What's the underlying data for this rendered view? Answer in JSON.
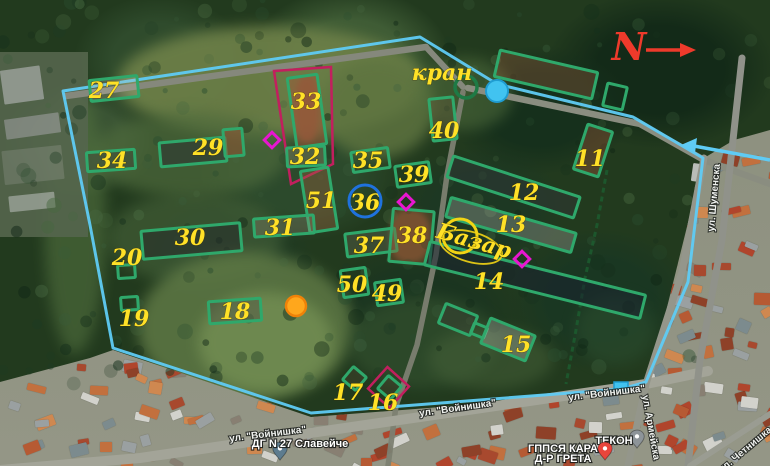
{
  "map_data": {
    "compass_label": "N",
    "annotations": {
      "crane": {
        "text": "кран",
        "x": 442,
        "y": 80,
        "rot": 0
      },
      "bazaar": {
        "text": "Базар",
        "x": 472,
        "y": 248,
        "rot": 16
      }
    },
    "style": {
      "boundary_cyan": "#5fcbf4",
      "building_green": "#2fa86b",
      "number_yellow": "#ffe127",
      "magenta": "#e816d0",
      "crimson": "#c21f5e",
      "blue_circle": "#1f72dd",
      "yellow_circle": "#f2d414",
      "orange_fill": "#ffa71c",
      "orange_stroke": "#ef8208",
      "cyan_fill": "#41c3f0",
      "cyan_stroke": "#1f9cd1",
      "crane_green": "#1e7a45",
      "north_red": "#ee3a2b",
      "dark_green_dash": "#1c5c2f"
    },
    "buildings": [
      {
        "id": "27",
        "label": "27",
        "x": 90,
        "y": 78,
        "w": 48,
        "h": 21,
        "rot": -6,
        "lx": 104,
        "ly": 90,
        "fill": "rgba(205,195,175,0.25)"
      },
      {
        "id": "34",
        "label": "34",
        "x": 87,
        "y": 151,
        "w": 48,
        "h": 19,
        "rot": -4,
        "lx": 112,
        "ly": 160,
        "fill": "rgba(60,65,60,0.35)"
      },
      {
        "id": "29",
        "label": "29",
        "x": 160,
        "y": 140,
        "w": 66,
        "h": 24,
        "rot": -5,
        "lx": 208,
        "ly": 147,
        "fill": "rgba(40,45,50,0.45)"
      },
      {
        "id": "29a",
        "label": "",
        "x": 224,
        "y": 129,
        "w": 19,
        "h": 27,
        "rot": -5,
        "lx": 0,
        "ly": 0,
        "fill": "rgba(160,80,50,0.45)"
      },
      {
        "id": "33",
        "label": "33",
        "x": 292,
        "y": 76,
        "w": 30,
        "h": 70,
        "rot": -8,
        "lx": 306,
        "ly": 101,
        "fill": "rgba(160,85,55,0.5)"
      },
      {
        "id": "32",
        "label": "32",
        "x": 287,
        "y": 147,
        "w": 38,
        "h": 19,
        "rot": -3,
        "lx": 305,
        "ly": 156,
        "fill": "rgba(170,150,120,0.3)"
      },
      {
        "id": "51",
        "label": "51",
        "x": 305,
        "y": 169,
        "w": 28,
        "h": 62,
        "rot": -9,
        "lx": 321,
        "ly": 200,
        "fill": "rgba(150,95,60,0.4)"
      },
      {
        "id": "31",
        "label": "31",
        "x": 254,
        "y": 217,
        "w": 60,
        "h": 18,
        "rot": -4,
        "lx": 280,
        "ly": 227,
        "fill": "rgba(150,140,120,0.3)"
      },
      {
        "id": "30",
        "label": "30",
        "x": 142,
        "y": 227,
        "w": 99,
        "h": 28,
        "rot": -5,
        "lx": 190,
        "ly": 237,
        "fill": "rgba(35,40,42,0.5)"
      },
      {
        "id": "20",
        "label": "20",
        "x": 118,
        "y": 265,
        "w": 17,
        "h": 13,
        "rot": -4,
        "lx": 127,
        "ly": 257,
        "fill": "none"
      },
      {
        "id": "19",
        "label": "19",
        "x": 121,
        "y": 297,
        "w": 17,
        "h": 13,
        "rot": -4,
        "lx": 134,
        "ly": 318,
        "fill": "none"
      },
      {
        "id": "18",
        "label": "18",
        "x": 209,
        "y": 300,
        "w": 52,
        "h": 22,
        "rot": -4,
        "lx": 235,
        "ly": 311,
        "fill": "rgba(75,75,68,0.4)"
      },
      {
        "id": "35",
        "label": "35",
        "x": 352,
        "y": 150,
        "w": 37,
        "h": 20,
        "rot": -8,
        "lx": 368,
        "ly": 160,
        "fill": "none"
      },
      {
        "id": "39",
        "label": "39",
        "x": 396,
        "y": 164,
        "w": 34,
        "h": 21,
        "rot": -8,
        "lx": 414,
        "ly": 174,
        "fill": "none"
      },
      {
        "id": "36",
        "label": "36",
        "x": 365,
        "y": 202,
        "w": 0,
        "h": 0,
        "rot": 0,
        "lx": 365,
        "ly": 202,
        "fill": "none"
      },
      {
        "id": "37",
        "label": "37",
        "x": 346,
        "y": 231,
        "w": 50,
        "h": 23,
        "rot": -7,
        "lx": 369,
        "ly": 245,
        "fill": "rgba(120,115,100,0.3)"
      },
      {
        "id": "38",
        "label": "38",
        "x": 391,
        "y": 210,
        "w": 41,
        "h": 53,
        "rot": 5,
        "lx": 412,
        "ly": 235,
        "fill": "rgba(145,85,50,0.35)"
      },
      {
        "id": "50",
        "label": "50",
        "x": 342,
        "y": 269,
        "w": 25,
        "h": 27,
        "rot": -8,
        "lx": 352,
        "ly": 284,
        "fill": "none"
      },
      {
        "id": "49",
        "label": "49",
        "x": 376,
        "y": 281,
        "w": 26,
        "h": 23,
        "rot": -8,
        "lx": 387,
        "ly": 293,
        "fill": "none"
      },
      {
        "id": "40",
        "label": "40",
        "x": 431,
        "y": 98,
        "w": 24,
        "h": 42,
        "rot": -6,
        "lx": 444,
        "ly": 130,
        "fill": "rgba(100,85,60,0.35)"
      },
      {
        "id": "11",
        "label": "11",
        "x": 580,
        "y": 127,
        "w": 26,
        "h": 47,
        "rot": 18,
        "lx": 590,
        "ly": 158,
        "fill": "rgba(170,90,60,0.35)"
      },
      {
        "id": "12",
        "label": "12",
        "x": 447,
        "y": 176,
        "w": 133,
        "h": 22,
        "rot": 18,
        "lx": 524,
        "ly": 192,
        "fill": "rgba(50,55,58,0.45)"
      },
      {
        "id": "13",
        "label": "13",
        "x": 446,
        "y": 215,
        "w": 130,
        "h": 20,
        "rot": 16,
        "lx": 511,
        "ly": 224,
        "fill": "rgba(190,190,185,0.3)"
      },
      {
        "id": "14",
        "label": "14",
        "x": 424,
        "y": 268,
        "w": 222,
        "h": 24,
        "rot": 14,
        "lx": 489,
        "ly": 281,
        "fill": "rgba(25,35,48,0.55)"
      },
      {
        "id": "15a",
        "label": "",
        "x": 441,
        "y": 309,
        "w": 34,
        "h": 21,
        "rot": 22,
        "lx": 0,
        "ly": 0,
        "fill": "rgba(60,60,55,0.35)"
      },
      {
        "id": "15b",
        "label": "",
        "x": 472,
        "y": 325,
        "w": 14,
        "h": 11,
        "rot": 22,
        "lx": 0,
        "ly": 0,
        "fill": "none"
      },
      {
        "id": "15",
        "label": "15",
        "x": 484,
        "y": 326,
        "w": 48,
        "h": 27,
        "rot": 22,
        "lx": 516,
        "ly": 344,
        "fill": "rgba(200,200,195,0.3)"
      },
      {
        "id": "16",
        "label": "16",
        "x": 381,
        "y": 379,
        "w": 17,
        "h": 17,
        "rot": 40,
        "lx": 383,
        "ly": 402,
        "fill": "rgba(80,70,50,0.35)"
      },
      {
        "id": "17",
        "label": "17",
        "x": 346,
        "y": 370,
        "w": 17,
        "h": 17,
        "rot": 40,
        "lx": 348,
        "ly": 392,
        "fill": "rgba(80,70,50,0.35)"
      },
      {
        "id": "tr1",
        "label": "",
        "x": 496,
        "y": 61,
        "w": 100,
        "h": 27,
        "rot": 13,
        "lx": 0,
        "ly": 0,
        "fill": "rgba(175,95,65,0.3)"
      },
      {
        "id": "tr2",
        "label": "",
        "x": 605,
        "y": 85,
        "w": 20,
        "h": 23,
        "rot": 13,
        "lx": 0,
        "ly": 0,
        "fill": "none"
      }
    ],
    "boundary": "420,37 497,84 633,117 703,158 688,282 646,382 622,389 311,413 113,348 90,225 63,91",
    "markers": {
      "crimson_outline": "274,71 331,67 333,164 291,184",
      "crimson_diamond": {
        "x": 374,
        "y": 373,
        "s": 29,
        "rot": 42
      },
      "magenta_diamonds": [
        {
          "cx": 272,
          "cy": 140
        },
        {
          "cx": 406,
          "cy": 202
        },
        {
          "cx": 522,
          "cy": 259
        }
      ],
      "crane_circle": {
        "cx": 466,
        "cy": 87,
        "r": 11
      },
      "cyan_circle": {
        "cx": 497,
        "cy": 91,
        "r": 11
      },
      "blue_circle": {
        "cx": 365,
        "cy": 201,
        "r": 16
      },
      "bazaar_circle": {
        "cx": 460,
        "cy": 236,
        "r": 17
      },
      "bazaar_ellipse": {
        "cx": 471,
        "cy": 247,
        "rx": 32,
        "ry": 15,
        "rot": 16
      },
      "orange_circle": {
        "cx": 296,
        "cy": 306,
        "r": 10
      },
      "cyan_square": {
        "x": 614,
        "y": 382,
        "w": 14,
        "h": 9
      },
      "dash_line": "607,170 597,225 585,278 576,330 566,384",
      "cyan_arrow": {
        "line": "770,160 694,146",
        "head": "681,145 697,138 695,153"
      },
      "north": {
        "x": 629,
        "y": 60,
        "line": "646,50 684,50",
        "head": "696,50 680,43 680,57"
      }
    },
    "roads": [
      {
        "pts": "66,96 426,47",
        "w": 6.5,
        "c": "#85887c"
      },
      {
        "pts": "426,47 463,87",
        "w": 6,
        "c": "#85887c"
      },
      {
        "pts": "468,88 640,124 704,160 770,184",
        "w": 6.5,
        "c": "#8a8d80"
      },
      {
        "pts": "463,92 447,175 436,255 417,345 396,406 388,466",
        "w": 5.5,
        "c": "#7c8071",
        "o": 0.95
      },
      {
        "pts": "0,470 140,458 646,384 708,371",
        "w": 10,
        "c": "#a3a498"
      },
      {
        "pts": "704,158 682,272 646,384 628,466",
        "w": 7,
        "c": "#94968b"
      },
      {
        "pts": "742,58 722,240 700,360 688,466",
        "w": 7,
        "c": "#90928a"
      },
      {
        "pts": "690,466 770,414",
        "w": 6,
        "c": "#9a9c92"
      }
    ],
    "streets": [
      {
        "text": "ул. \"Войнишка\"",
        "x": 458,
        "y": 411,
        "rot": -8
      },
      {
        "text": "ул. \"Войнишка\"",
        "x": 268,
        "y": 437,
        "rot": -7
      },
      {
        "text": "ул. \"Войнишка\"",
        "x": 607,
        "y": 396,
        "rot": -7
      },
      {
        "text": "ул. Шуменска",
        "x": 717,
        "y": 198,
        "rot": -85
      },
      {
        "text": "ул. Армейска",
        "x": 648,
        "y": 428,
        "rot": 80
      },
      {
        "text": "ул. Четнишка",
        "x": 747,
        "y": 452,
        "rot": -40
      }
    ],
    "pois": [
      {
        "text": "ДГ N 27 Славейче",
        "text2": "",
        "x": 300,
        "y": 447,
        "pin": "#5d7c8f",
        "px": 280,
        "py": 452
      },
      {
        "text": "ТЕКОН",
        "text2": "",
        "x": 614,
        "y": 444,
        "pin": "#8d9499",
        "px": 637,
        "py": 440
      },
      {
        "text": "ГППСЯ КАРА",
        "text2": "Д-Р ГРЕТА",
        "x": 563,
        "y": 452,
        "pin": "#e9453c",
        "px": 605,
        "py": 452
      }
    ]
  }
}
